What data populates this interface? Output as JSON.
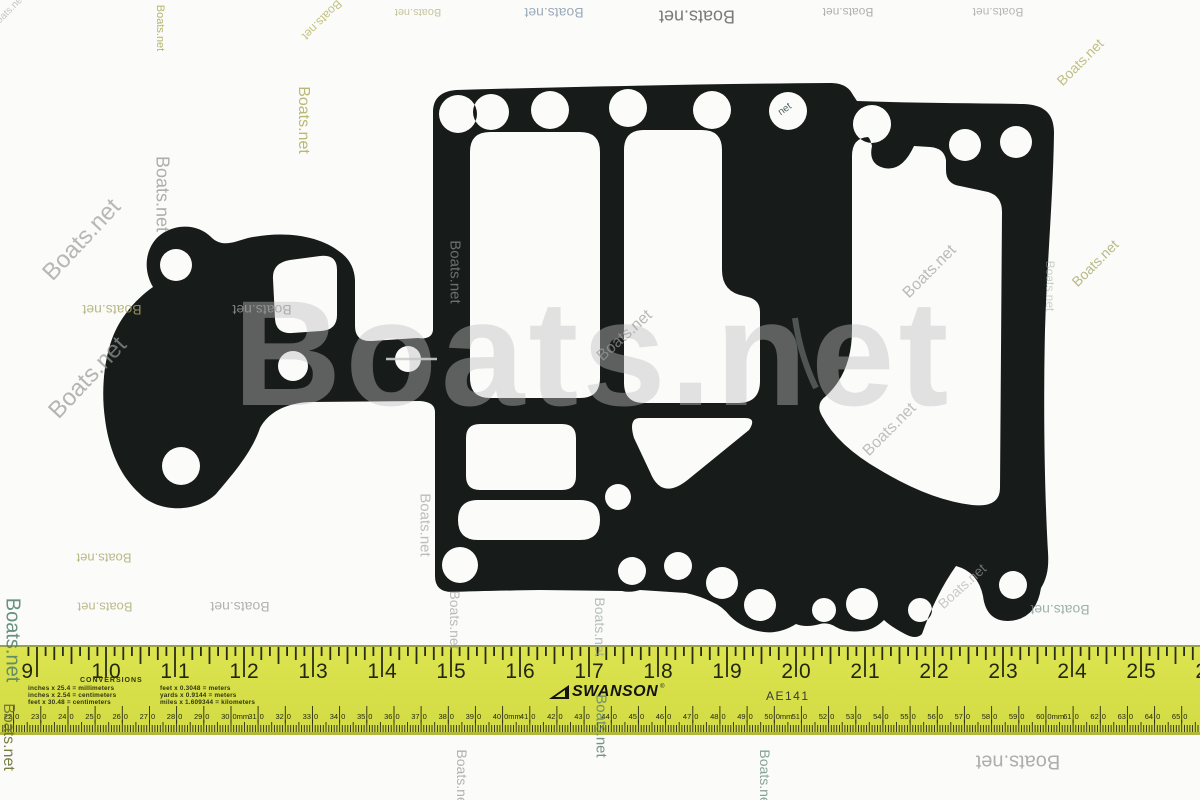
{
  "watermark": {
    "text": "Boats.net",
    "hole_text": "net",
    "giant": {
      "x": 233,
      "y": 278,
      "size": 150,
      "letter_spacing": 4,
      "color": "#bfbfbf",
      "opacity": 0.42
    },
    "items": [
      {
        "x": 160,
        "y": 28,
        "rot": 90,
        "size": 11,
        "color": "#a8a855",
        "op": 0.85
      },
      {
        "x": 322,
        "y": 20,
        "rot": 135,
        "size": 12,
        "color": "#b3b364",
        "op": 0.8
      },
      {
        "x": 303,
        "y": 120,
        "rot": 90,
        "size": 16,
        "color": "#aeae5e",
        "op": 0.85
      },
      {
        "x": 418,
        "y": 12,
        "rot": 180,
        "size": 11,
        "color": "#bcbc8e",
        "op": 0.85
      },
      {
        "x": 554,
        "y": 13,
        "rot": 180,
        "size": 14,
        "color": "#93a3b3",
        "op": 0.9
      },
      {
        "x": 697,
        "y": 16,
        "rot": 180,
        "size": 18,
        "color": "#6e6e6e",
        "op": 0.9
      },
      {
        "x": 848,
        "y": 12,
        "rot": 180,
        "size": 12,
        "color": "#a3a3a3",
        "op": 0.85
      },
      {
        "x": 998,
        "y": 12,
        "rot": 180,
        "size": 12,
        "color": "#ababab",
        "op": 0.85
      },
      {
        "x": 1080,
        "y": 62,
        "rot": -45,
        "size": 14,
        "color": "#b1b168",
        "op": 0.8
      },
      {
        "x": 162,
        "y": 194,
        "rot": 90,
        "size": 18,
        "color": "#9b9b9b",
        "op": 0.8
      },
      {
        "x": 82,
        "y": 240,
        "rot": -47,
        "size": 24,
        "color": "#9b9b9b",
        "op": 0.7
      },
      {
        "x": 88,
        "y": 378,
        "rot": -47,
        "size": 24,
        "color": "#989898",
        "op": 0.7
      },
      {
        "x": 112,
        "y": 310,
        "rot": 180,
        "size": 14,
        "color": "#aaa96a",
        "op": 0.8
      },
      {
        "x": 262,
        "y": 310,
        "rot": 180,
        "size": 14,
        "color": "#9f9f9f",
        "op": 0.8
      },
      {
        "x": 455,
        "y": 272,
        "rot": 90,
        "size": 15,
        "color": "#c0c3c1",
        "op": 0.5
      },
      {
        "x": 625,
        "y": 336,
        "rot": -42,
        "size": 16,
        "color": "#9c9c9c",
        "op": 0.7
      },
      {
        "x": 930,
        "y": 272,
        "rot": -45,
        "size": 16,
        "color": "#9f9f9f",
        "op": 0.7
      },
      {
        "x": 1095,
        "y": 263,
        "rot": -45,
        "size": 14,
        "color": "#aaa96a",
        "op": 0.8
      },
      {
        "x": 1050,
        "y": 286,
        "rot": 90,
        "size": 12,
        "color": "#93a79d",
        "op": 0.5
      },
      {
        "x": 890,
        "y": 430,
        "rot": -45,
        "size": 16,
        "color": "#9f9f9f",
        "op": 0.65
      },
      {
        "x": 962,
        "y": 586,
        "rot": -42,
        "size": 14,
        "color": "#a8a8a8",
        "op": 0.6
      },
      {
        "x": 104,
        "y": 558,
        "rot": 180,
        "size": 13,
        "color": "#aaa96a",
        "op": 0.8
      },
      {
        "x": 105,
        "y": 607,
        "rot": 180,
        "size": 13,
        "color": "#adac70",
        "op": 0.8
      },
      {
        "x": 240,
        "y": 607,
        "rot": 180,
        "size": 14,
        "color": "#9f9f9f",
        "op": 0.8
      },
      {
        "x": 425,
        "y": 525,
        "rot": 90,
        "size": 15,
        "color": "#9b9b9b",
        "op": 0.65
      },
      {
        "x": 455,
        "y": 620,
        "rot": 90,
        "size": 14,
        "color": "#9f9f9f",
        "op": 0.7
      },
      {
        "x": 600,
        "y": 627,
        "rot": 90,
        "size": 14,
        "color": "#9aa39f",
        "op": 0.7
      },
      {
        "x": 601,
        "y": 726,
        "rot": 90,
        "size": 15,
        "color": "#5f8273",
        "op": 0.85
      },
      {
        "x": 1060,
        "y": 610,
        "rot": 180,
        "size": 14,
        "color": "#74938a",
        "op": 0.7
      },
      {
        "x": 12,
        "y": 640,
        "rot": 90,
        "size": 20,
        "color": "#4e7f6c",
        "op": 0.85
      },
      {
        "x": 8,
        "y": 737,
        "rot": 90,
        "size": 16,
        "color": "#6d7030",
        "op": 0.9
      },
      {
        "x": 462,
        "y": 779,
        "rot": 90,
        "size": 14,
        "color": "#9f9f9f",
        "op": 0.8
      },
      {
        "x": 765,
        "y": 779,
        "rot": 90,
        "size": 14,
        "color": "#6a8d7e",
        "op": 0.8
      },
      {
        "x": 1018,
        "y": 761,
        "rot": 180,
        "size": 20,
        "color": "#9b9b9b",
        "op": 0.8
      },
      {
        "x": 8,
        "y": 12,
        "rot": -45,
        "size": 10,
        "color": "#9f9f9f",
        "op": 0.6
      }
    ]
  },
  "gasket": {
    "color": "#171b19"
  },
  "ruler": {
    "brand": "SWANSON",
    "registered": "®",
    "model": "AE141",
    "body_color": "#d8e04e",
    "tick_color": "#2a2d16",
    "inches": {
      "start": 9,
      "end": 26
    },
    "mm": {
      "start": 220,
      "end": 660,
      "step": 10,
      "mm_suffix_at": [
        300,
        400,
        500,
        600
      ]
    },
    "conversions": {
      "title": "CONVERSIONS",
      "left": [
        "inches x 25.4 = millimeters",
        "inches x 2.54 = centimeters",
        "feet x 30.48 = centimeters"
      ],
      "right": [
        "feet x 0.3048 = meters",
        "yards x 0.9144 = meters",
        "miles x 1.609344 = kilometers"
      ]
    }
  }
}
